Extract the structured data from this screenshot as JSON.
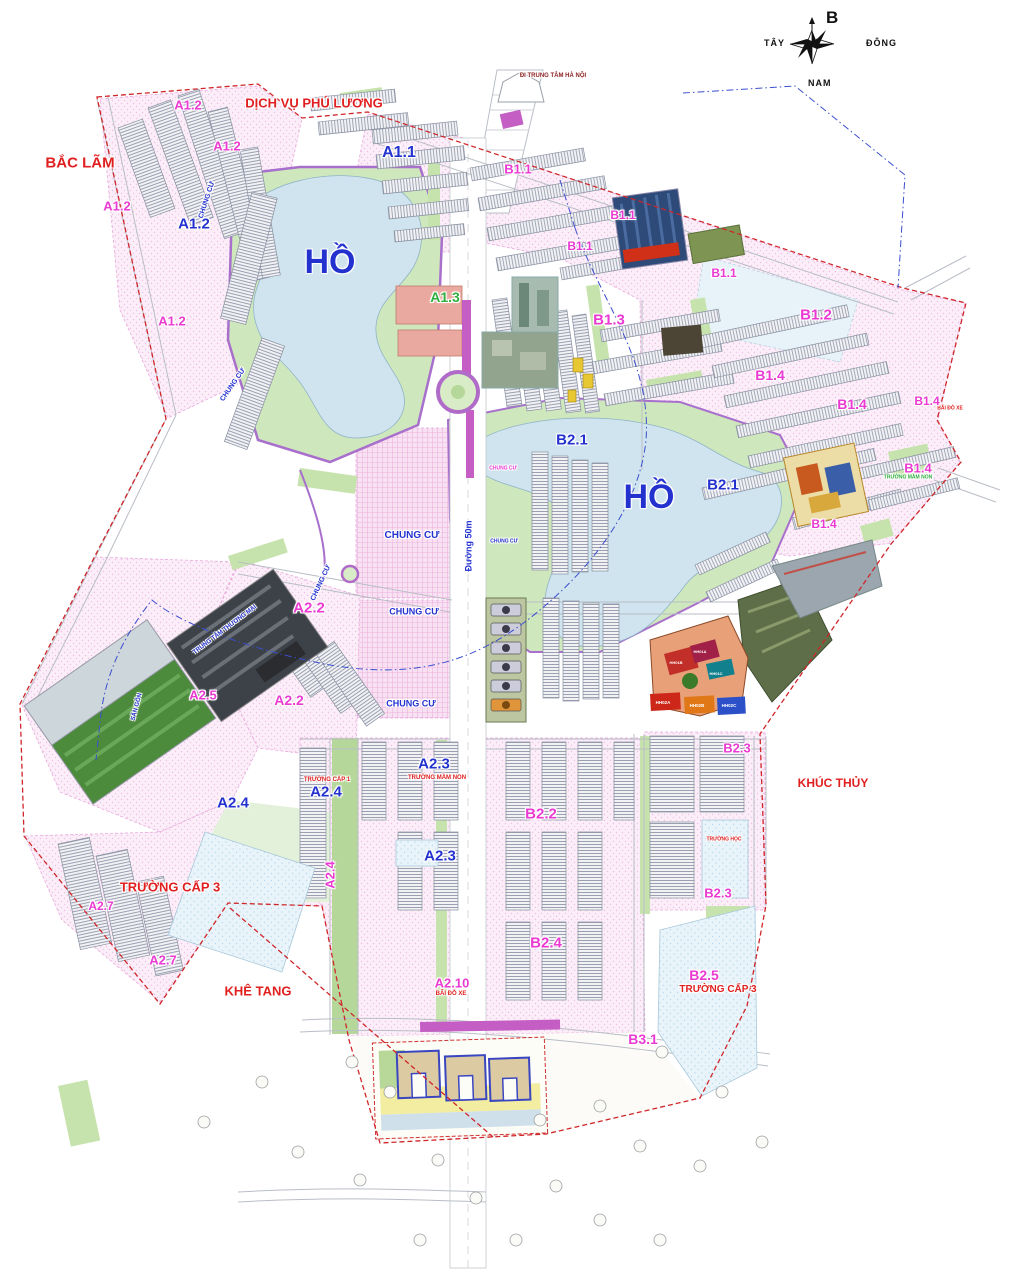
{
  "compass": {
    "north": "B",
    "west": "TÂY",
    "east": "ĐÔNG",
    "south": "NAM"
  },
  "palette": {
    "red": "#e02020",
    "mag": "#ea3ad2",
    "blue": "#2331cf",
    "green": "#2fae3e",
    "darkred": "#8b1f1f",
    "black": "#444444",
    "white": "#ffffff",
    "lake": "#cfe4ee",
    "park": "#cfe7bd",
    "zone_pink": "#fbeef8",
    "median_purple": "#c45ec4"
  },
  "labels": [
    {
      "t": "BẮC LÃM",
      "x": 80,
      "y": 163,
      "c": "red",
      "s": 15
    },
    {
      "t": "DỊCH VỤ PHÚ LƯƠNG",
      "x": 314,
      "y": 103,
      "c": "red",
      "s": 13
    },
    {
      "t": "KHÚC THỦY",
      "x": 833,
      "y": 783,
      "c": "red",
      "s": 12
    },
    {
      "t": "KHÊ TANG",
      "x": 258,
      "y": 991,
      "c": "red",
      "s": 13
    },
    {
      "t": "TRƯỜNG CẤP 3",
      "x": 170,
      "y": 887,
      "c": "red",
      "s": 13
    },
    {
      "t": "TRƯỜNG CẤP 3",
      "x": 718,
      "y": 990,
      "c": "red",
      "s": 10
    },
    {
      "t": "TRƯỜNG MẦM NON",
      "x": 437,
      "y": 778,
      "c": "red",
      "s": 6
    },
    {
      "t": "TRƯỜNG CẤP 1",
      "x": 327,
      "y": 780,
      "c": "red",
      "s": 6
    },
    {
      "t": "BÃI ĐỖ XE",
      "x": 451,
      "y": 994,
      "c": "red",
      "s": 6
    },
    {
      "t": "BÃI ĐỖ XE",
      "x": 950,
      "y": 409,
      "c": "red",
      "s": 5
    },
    {
      "t": "TRƯỜNG HỌC",
      "x": 724,
      "y": 840,
      "c": "red",
      "s": 5
    },
    {
      "t": "ĐI TRUNG TÂM HÀ NỘI",
      "x": 553,
      "y": 76,
      "c": "darkred",
      "s": 6
    },
    {
      "t": "A1.1",
      "x": 399,
      "y": 153,
      "c": "blue",
      "s": 16
    },
    {
      "t": "A1.2",
      "x": 194,
      "y": 224,
      "c": "blue",
      "s": 15
    },
    {
      "t": "A1.2",
      "x": 188,
      "y": 105,
      "c": "mag",
      "s": 13
    },
    {
      "t": "A1.2",
      "x": 227,
      "y": 146,
      "c": "mag",
      "s": 13
    },
    {
      "t": "A1.2",
      "x": 117,
      "y": 206,
      "c": "mag",
      "s": 13
    },
    {
      "t": "A1.2",
      "x": 172,
      "y": 321,
      "c": "mag",
      "s": 13
    },
    {
      "t": "A1.3",
      "x": 445,
      "y": 297,
      "c": "green",
      "s": 14
    },
    {
      "t": "HỒ",
      "x": 330,
      "y": 262,
      "c": "blue",
      "s": 34
    },
    {
      "t": "HỒ",
      "x": 649,
      "y": 497,
      "c": "blue",
      "s": 34
    },
    {
      "t": "B1.1",
      "x": 518,
      "y": 169,
      "c": "mag",
      "s": 13
    },
    {
      "t": "B1.1",
      "x": 623,
      "y": 215,
      "c": "mag",
      "s": 12
    },
    {
      "t": "B1.1",
      "x": 580,
      "y": 246,
      "c": "mag",
      "s": 12
    },
    {
      "t": "B1.1",
      "x": 724,
      "y": 273,
      "c": "mag",
      "s": 12
    },
    {
      "t": "B1.2",
      "x": 816,
      "y": 315,
      "c": "mag",
      "s": 15
    },
    {
      "t": "B1.3",
      "x": 609,
      "y": 320,
      "c": "mag",
      "s": 15
    },
    {
      "t": "B1.4",
      "x": 770,
      "y": 375,
      "c": "mag",
      "s": 14
    },
    {
      "t": "B1.4",
      "x": 852,
      "y": 404,
      "c": "mag",
      "s": 14
    },
    {
      "t": "B1.4",
      "x": 927,
      "y": 401,
      "c": "mag",
      "s": 12
    },
    {
      "t": "B1.4",
      "x": 918,
      "y": 468,
      "c": "mag",
      "s": 13
    },
    {
      "t": "B1.4",
      "x": 824,
      "y": 524,
      "c": "mag",
      "s": 12
    },
    {
      "t": "B2.1",
      "x": 572,
      "y": 440,
      "c": "blue",
      "s": 15
    },
    {
      "t": "B2.1",
      "x": 723,
      "y": 485,
      "c": "blue",
      "s": 15
    },
    {
      "t": "A2.2",
      "x": 309,
      "y": 608,
      "c": "mag",
      "s": 15
    },
    {
      "t": "A2.2",
      "x": 289,
      "y": 700,
      "c": "mag",
      "s": 14
    },
    {
      "t": "A2.5",
      "x": 203,
      "y": 695,
      "c": "mag",
      "s": 13
    },
    {
      "t": "A2.3",
      "x": 434,
      "y": 764,
      "c": "blue",
      "s": 15
    },
    {
      "t": "A2.3",
      "x": 440,
      "y": 856,
      "c": "blue",
      "s": 15
    },
    {
      "t": "A2.4",
      "x": 326,
      "y": 792,
      "c": "blue",
      "s": 15
    },
    {
      "t": "A2.4",
      "x": 233,
      "y": 803,
      "c": "blue",
      "s": 15
    },
    {
      "t": "A2.4",
      "x": 330,
      "y": 875,
      "c": "mag",
      "s": 13,
      "r": -90
    },
    {
      "t": "A2.7",
      "x": 101,
      "y": 906,
      "c": "mag",
      "s": 12
    },
    {
      "t": "A2.7",
      "x": 163,
      "y": 960,
      "c": "mag",
      "s": 13
    },
    {
      "t": "A2.10",
      "x": 452,
      "y": 983,
      "c": "mag",
      "s": 13
    },
    {
      "t": "B2.2",
      "x": 541,
      "y": 814,
      "c": "mag",
      "s": 15
    },
    {
      "t": "B2.3",
      "x": 737,
      "y": 748,
      "c": "mag",
      "s": 13
    },
    {
      "t": "B2.3",
      "x": 718,
      "y": 893,
      "c": "mag",
      "s": 13
    },
    {
      "t": "B2.4",
      "x": 546,
      "y": 943,
      "c": "mag",
      "s": 15
    },
    {
      "t": "B2.5",
      "x": 704,
      "y": 975,
      "c": "mag",
      "s": 14
    },
    {
      "t": "B3.1",
      "x": 643,
      "y": 1039,
      "c": "mag",
      "s": 14
    },
    {
      "t": "CHUNG CƯ",
      "x": 207,
      "y": 200,
      "c": "blue",
      "s": 7,
      "r": -72
    },
    {
      "t": "CHUNG CƯ",
      "x": 233,
      "y": 385,
      "c": "blue",
      "s": 7,
      "r": -55
    },
    {
      "t": "CHUNG CƯ",
      "x": 321,
      "y": 583,
      "c": "blue",
      "s": 7,
      "r": -65
    },
    {
      "t": "CHUNG CƯ",
      "x": 412,
      "y": 536,
      "c": "blue",
      "s": 10
    },
    {
      "t": "CHUNG CƯ",
      "x": 414,
      "y": 612,
      "c": "blue",
      "s": 9
    },
    {
      "t": "CHUNG CƯ",
      "x": 411,
      "y": 704,
      "c": "blue",
      "s": 9
    },
    {
      "t": "CHUNG CƯ",
      "x": 503,
      "y": 469,
      "c": "mag",
      "s": 5
    },
    {
      "t": "CHUNG CƯ",
      "x": 504,
      "y": 542,
      "c": "blue",
      "s": 5
    },
    {
      "t": "Đường 50m",
      "x": 469,
      "y": 546,
      "c": "blue",
      "s": 9,
      "r": -90
    },
    {
      "t": "SÂN GÔN",
      "x": 137,
      "y": 707,
      "c": "blue",
      "s": 6,
      "r": -75
    },
    {
      "t": "TRUNG TÂM THƯƠNG MẠI",
      "x": 225,
      "y": 630,
      "c": "blue",
      "s": 6,
      "r": -37
    },
    {
      "t": "TRƯỜNG MẦM NON",
      "x": 908,
      "y": 478,
      "c": "green",
      "s": 5
    },
    {
      "t": "HH01A",
      "x": 700,
      "y": 652,
      "c": "white",
      "s": 4
    },
    {
      "t": "HH01B",
      "x": 676,
      "y": 663,
      "c": "white",
      "s": 4
    },
    {
      "t": "HH01C",
      "x": 716,
      "y": 674,
      "c": "white",
      "s": 4
    },
    {
      "t": "HH02A",
      "x": 663,
      "y": 703,
      "c": "white",
      "s": 4.5
    },
    {
      "t": "HH02B",
      "x": 697,
      "y": 706,
      "c": "white",
      "s": 4.5
    },
    {
      "t": "HH02C",
      "x": 729,
      "y": 706,
      "c": "white",
      "s": 4.5
    }
  ]
}
